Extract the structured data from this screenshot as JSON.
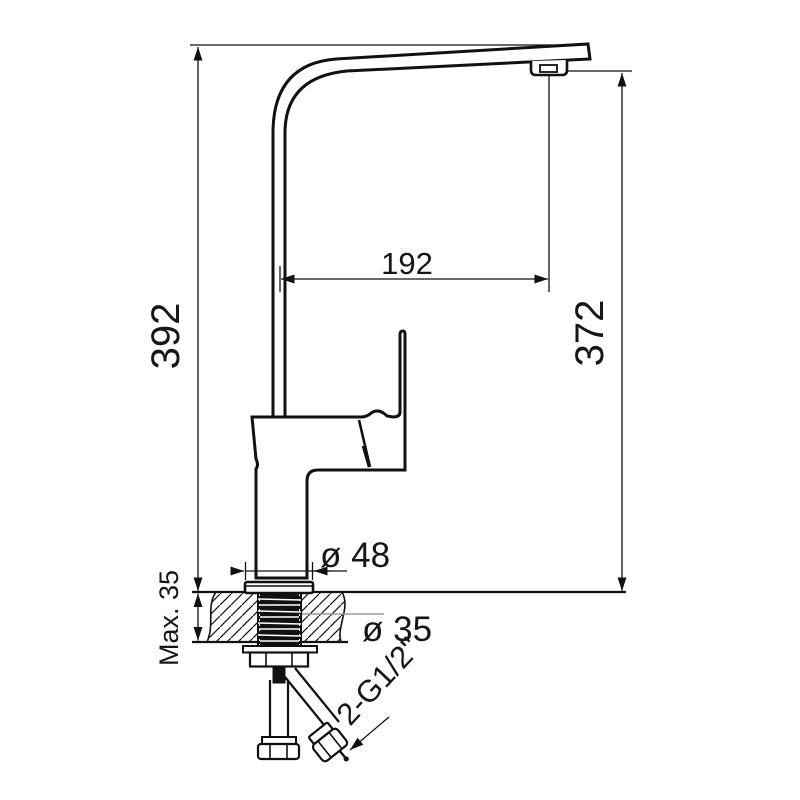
{
  "drawing": {
    "title": "kitchen-faucet-dimension-drawing",
    "view": "side-elevation-cross-section",
    "units": "mm",
    "labels": {
      "overall_height": "392",
      "outlet_height": "372",
      "spout_reach": "192",
      "base_diameter": "ø 48",
      "hole_diameter": "ø 35",
      "max_deck_thickness": "Max. 35",
      "inlet_thread": "2-G1/2\""
    },
    "colors": {
      "line": "#111111",
      "background": "#ffffff",
      "leader_gray": "#9a9a9a"
    }
  }
}
